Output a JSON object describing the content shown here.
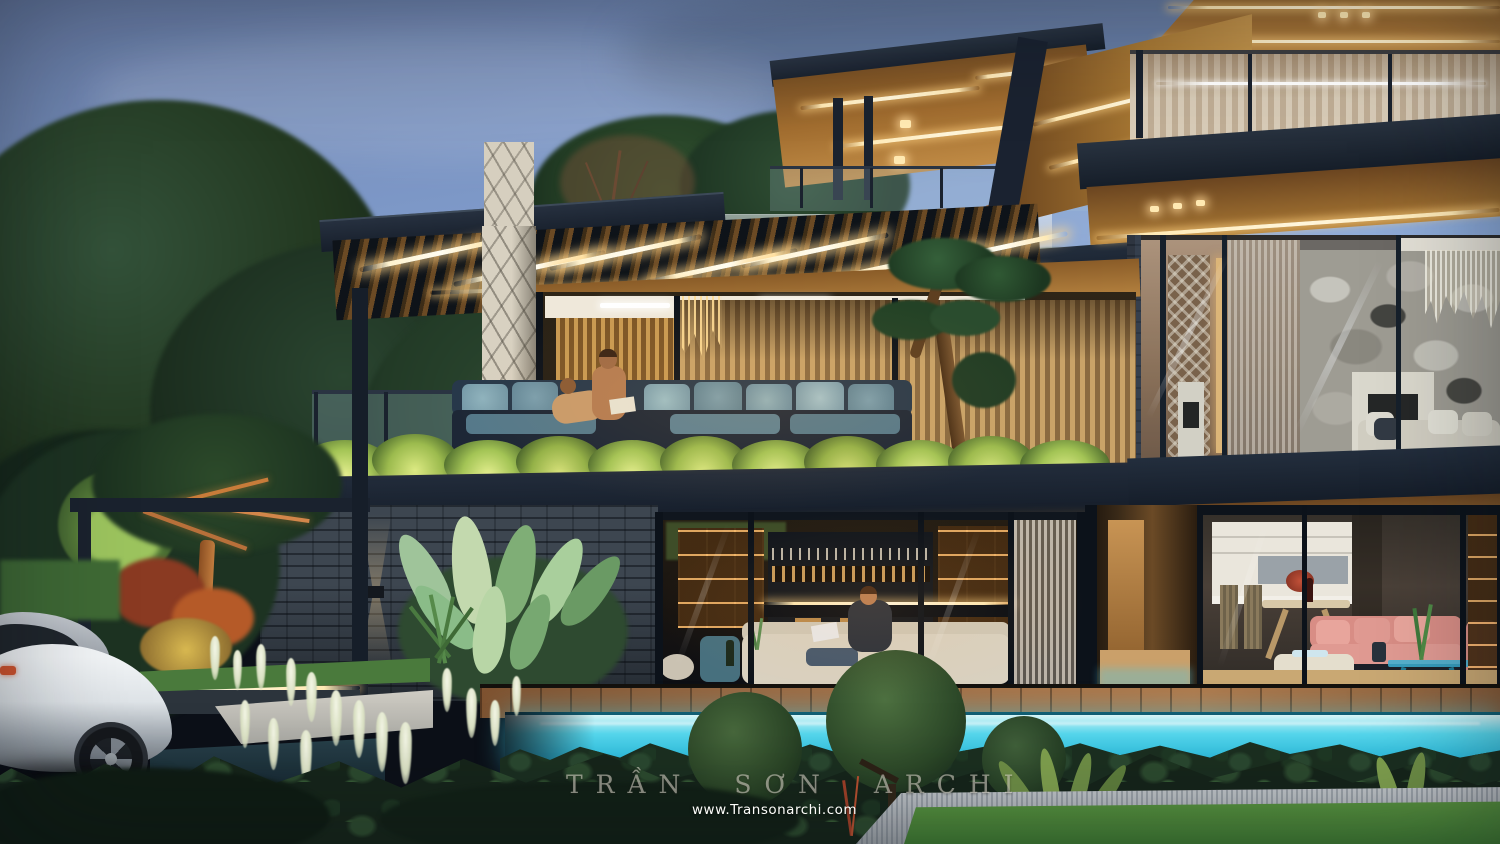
{
  "watermark": {
    "studio": "TRẦN SƠN ARCHI",
    "website": "www.Transonarchi.com"
  },
  "palette": {
    "sky_top": "#64779f",
    "sky_mid": "#87a6d6",
    "sky_low": "#aec7e8",
    "roof_fascia": "#1e2835",
    "wood_warm": "#b07a3c",
    "led_glow": "#ffe9b4",
    "pool_cyan": "#2cc4e8",
    "foliage_dark": "#203826",
    "foliage_lit": "#c3d465",
    "stone_pillar": "#d6cfbf",
    "brick_wall": "#3d4650",
    "deck_wood": "#9c6b44",
    "sofa_teal": "#7b9fae",
    "sofa_pink": "#d88d85",
    "car_body": "#e8ebee",
    "lawn_green": "#4a8a38",
    "stone_path": "#b4bac0"
  }
}
